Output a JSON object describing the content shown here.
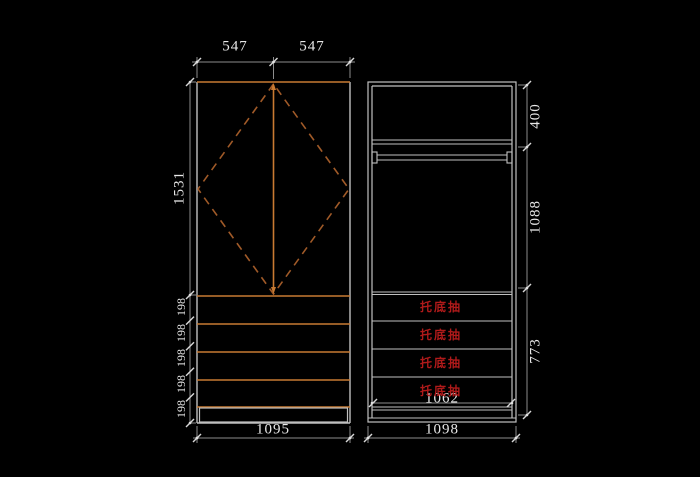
{
  "front_view": {
    "top_width_dims": [
      "547",
      "547"
    ],
    "door_height_dim": "1531",
    "drawer_height_dims": [
      "198",
      "198",
      "198",
      "198",
      "198"
    ],
    "overall_width_dim": "1095"
  },
  "side_view": {
    "top_shelf_height_dim": "400",
    "hanging_height_dim": "1088",
    "drawer_zone_height_dim": "773",
    "inner_width_dim": "1062",
    "overall_width_dim": "1098",
    "drawer_labels": [
      "托底抽",
      "托底抽",
      "托底抽",
      "托底抽"
    ]
  },
  "colors": {
    "background": "#000000",
    "cabinet_outline": "#c0c0c0",
    "panel_orange": "#c87a32",
    "diamond_dash_orange": "#a05a28",
    "dimension_line": "#8d8d8d",
    "dimension_text": "#e8e8e8",
    "drawer_label_red": "#b01a1a"
  }
}
